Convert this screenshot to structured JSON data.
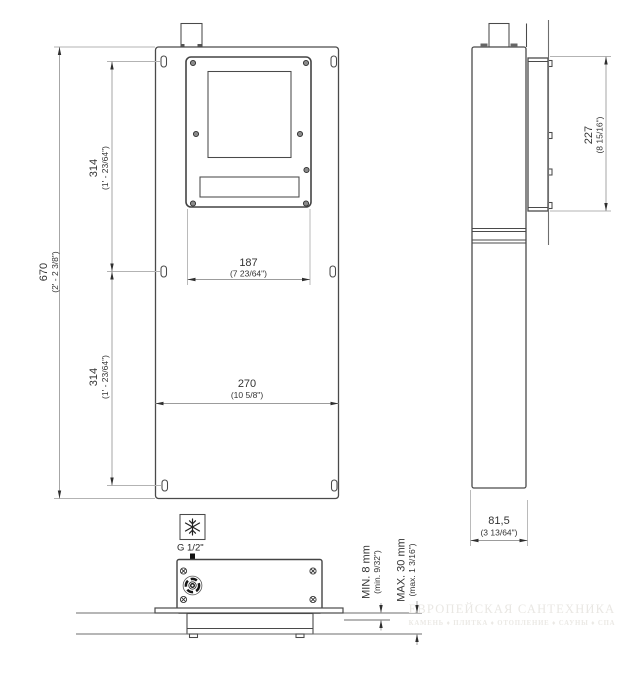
{
  "views": {
    "front": {
      "height": {
        "mm": "670",
        "in": "(2' - 2 3/8\")"
      },
      "upper_span": {
        "mm": "314",
        "in": "(1' - 23/64\")"
      },
      "lower_span": {
        "mm": "314",
        "in": "(1' - 23/64\")"
      },
      "cutout_width": {
        "mm": "187",
        "in": "(7 23/64\")"
      },
      "width": {
        "mm": "270",
        "in": "(10 5/8\")"
      }
    },
    "side": {
      "frame_height": {
        "mm": "227",
        "in": "(8 15/16\")"
      },
      "depth": {
        "mm": "81,5",
        "in": "(3 13/64\")"
      }
    },
    "bottom": {
      "thread_label": "G 1/2\"",
      "cold_water_icon": "snowflake-icon",
      "wall_min": {
        "label": "MIN. 8 mm",
        "in": "(min. 9/32\")"
      },
      "wall_max": {
        "label": "MAX. 30 mm",
        "in": "(max. 1 3/16\")"
      }
    }
  },
  "watermark": {
    "title": "ЕВРОПЕЙСКАЯ САНТЕХНИКА",
    "subtitle": "КАМЕНЬ ♦ ПЛИТКА ♦ ОТОПЛЕНИЕ ♦ САУНЫ ♦ СПА"
  },
  "colors": {
    "line": "#4a4a4a",
    "dimension_line": "#9c9c9c",
    "extension_line": "#b3b3b3",
    "text": "#333333",
    "watermark": "#e9e7e3",
    "background": "#ffffff"
  }
}
